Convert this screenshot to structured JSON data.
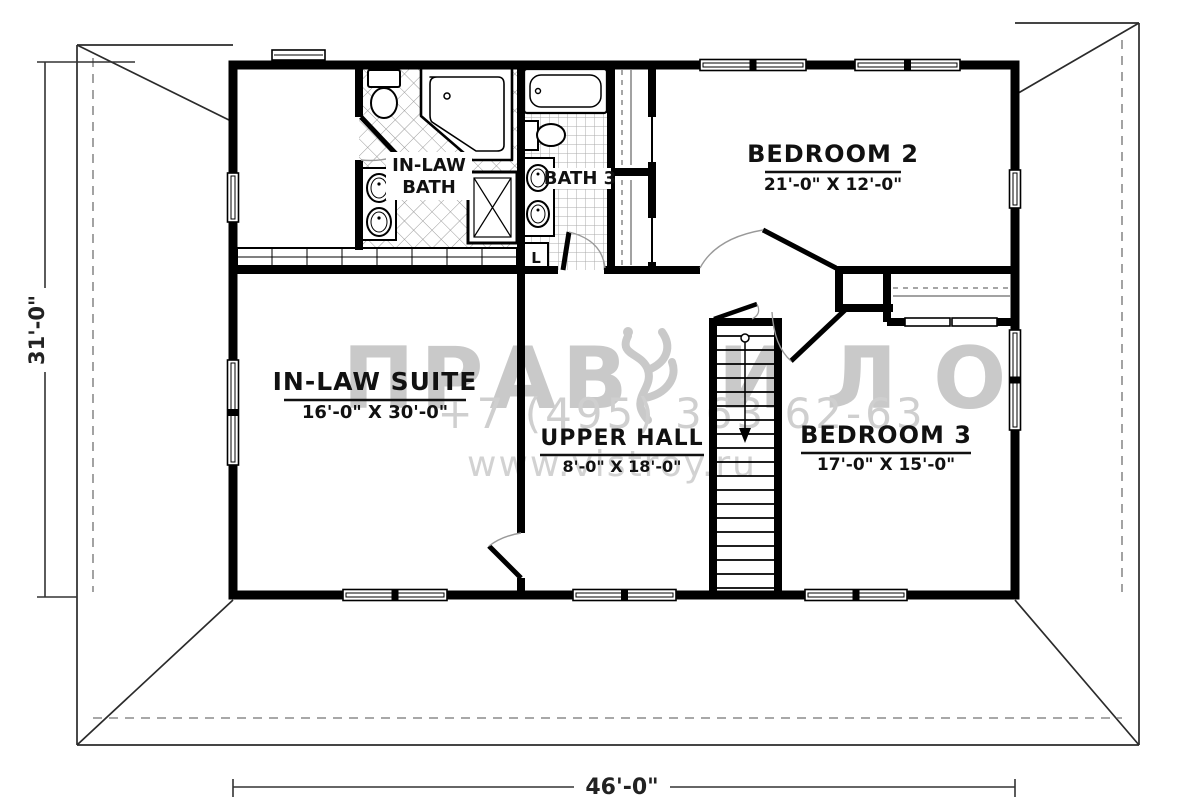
{
  "plan": {
    "rooms": {
      "inlaw_suite": {
        "name": "IN-LAW SUITE",
        "dims": "16'-0\" X 30'-0\""
      },
      "upper_hall": {
        "name": "UPPER HALL",
        "dims": "8'-0\" X 18'-0\""
      },
      "bedroom2": {
        "name": "BEDROOM 2",
        "dims": "21'-0\" X 12'-0\""
      },
      "bedroom3": {
        "name": "BEDROOM 3",
        "dims": "17'-0\" X 15'-0\""
      },
      "inlaw_bath": {
        "line1": "IN-LAW",
        "line2": "BATH"
      },
      "bath3": {
        "name": "BATH 3"
      },
      "linen_closet": {
        "label": "L"
      }
    },
    "overall_dimensions": {
      "width": "46'-0\"",
      "depth": "31'-0\""
    }
  },
  "watermark": {
    "brand_prefix": "ПРАВ",
    "brand_suffix": "ИЛО",
    "phone": "+7 (495) 363 62-63",
    "website": "www.vistroy.ru",
    "color": "#c9c9c9"
  },
  "colors": {
    "wall": "#000000",
    "roof_line": "#2b2b2b",
    "dashed": "#8c8c8c",
    "background": "#ffffff"
  }
}
